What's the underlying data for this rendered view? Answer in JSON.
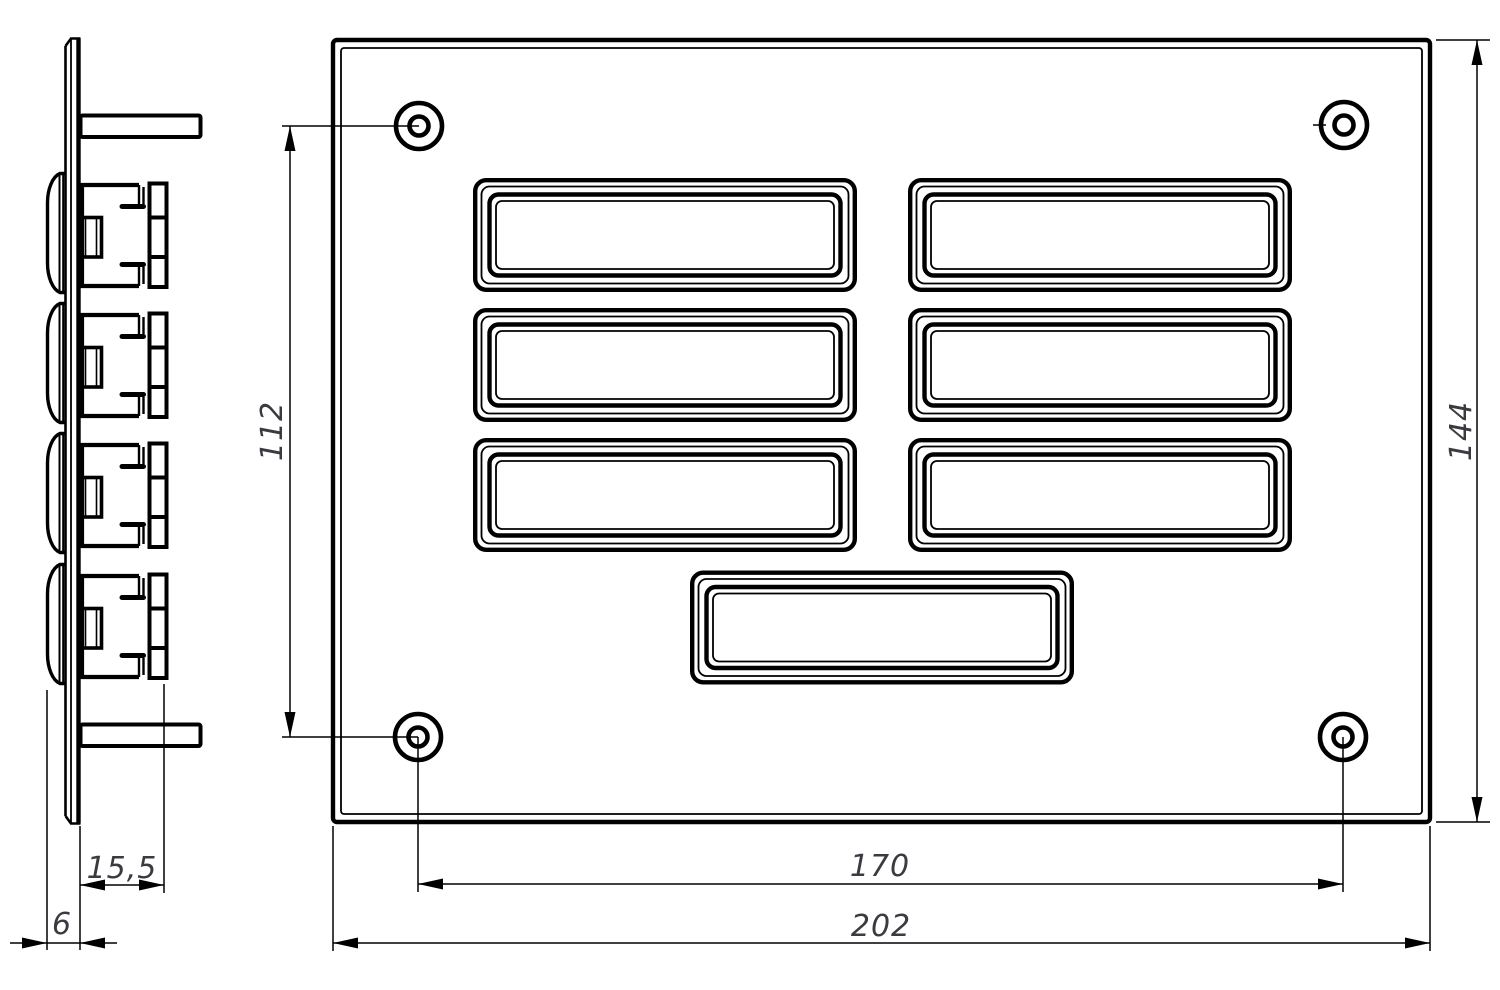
{
  "drawing": {
    "dimensions": {
      "hole_spacing_vertical": "112",
      "overall_height": "144",
      "mount_depth": "15,5",
      "plate_thickness": "6",
      "hole_spacing_horizontal": "170",
      "overall_width": "202"
    },
    "colors": {
      "line": "#000000",
      "dim_text": "#3a3a41",
      "background": "#ffffff"
    }
  }
}
